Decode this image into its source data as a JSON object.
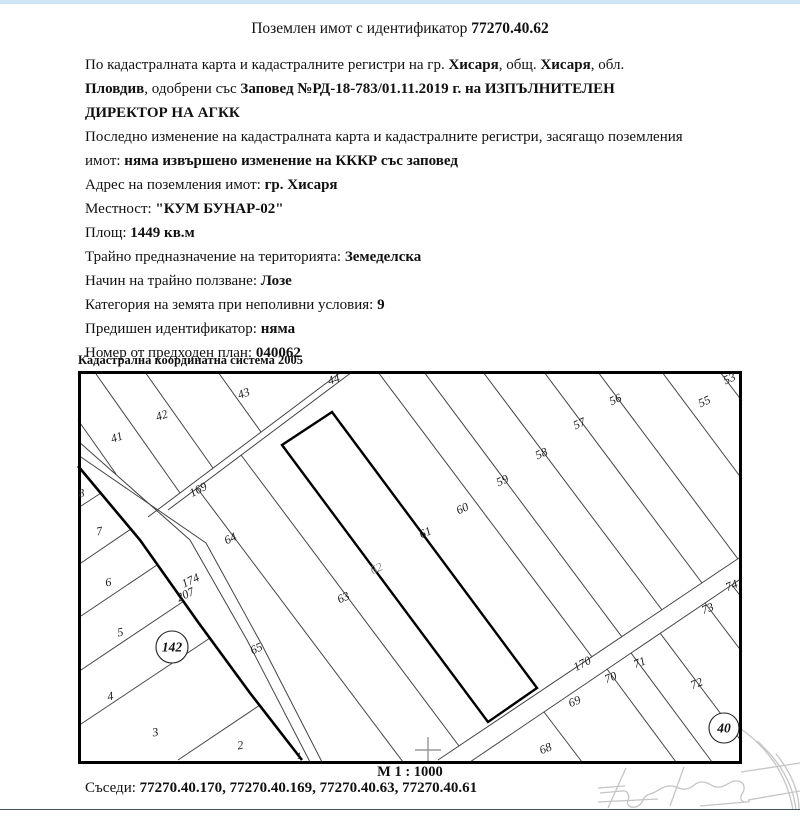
{
  "page": {
    "top_bar_color": "#cfe4f6"
  },
  "title": {
    "prefix": "Поземлен имот с идентификатор ",
    "id": "77270.40.62"
  },
  "text_rows": [
    [
      {
        "t": "По кадастралната карта и кадастралните регистри на гр. "
      },
      {
        "t": "Хисаря",
        "b": 1
      },
      {
        "t": ", общ. "
      },
      {
        "t": "Хисаря",
        "b": 1
      },
      {
        "t": ", обл."
      }
    ],
    [
      {
        "t": "Пловдив",
        "b": 1
      },
      {
        "t": ", одобрени със "
      },
      {
        "t": "Заповед №РД-18-783/01.11.2019 г. на ИЗПЪЛНИТЕЛЕН",
        "b": 1
      }
    ],
    [
      {
        "t": "ДИРЕКТОР НА АГКК",
        "b": 1
      }
    ],
    [
      {
        "t": "Последно изменение на кадастралната карта и кадастралните регистри, засягащо поземления"
      }
    ],
    [
      {
        "t": "имот: "
      },
      {
        "t": "няма извършено изменение на КККР със заповед",
        "b": 1
      }
    ],
    [
      {
        "t": "Адрес на поземления имот: "
      },
      {
        "t": "гр. Хисаря",
        "b": 1
      }
    ],
    [
      {
        "t": "Местност: "
      },
      {
        "t": "\"КУМ БУНАР-02\"",
        "b": 1
      }
    ],
    [
      {
        "t": "Площ: "
      },
      {
        "t": "1449 кв.м",
        "b": 1
      }
    ],
    [
      {
        "t": "Трайно предназначение на територията: "
      },
      {
        "t": "Земеделска",
        "b": 1
      }
    ],
    [
      {
        "t": "Начин на трайно ползване: "
      },
      {
        "t": "Лозе",
        "b": 1
      }
    ],
    [
      {
        "t": "Категория на земята при неполивни условия: "
      },
      {
        "t": "9",
        "b": 1
      }
    ],
    [
      {
        "t": "Предишен идентификатор: "
      },
      {
        "t": "няма",
        "b": 1
      }
    ],
    [
      {
        "t": "Номер от предходен план: "
      },
      {
        "t": "040062",
        "b": 1
      }
    ]
  ],
  "map": {
    "coordinate_system_label": "Кадастрална координатна система 2005",
    "scale_label": "М 1 : 1000",
    "parcel_labels": [
      {
        "text": "41",
        "x": 118,
        "y": 441,
        "rot": -20
      },
      {
        "text": "42",
        "x": 163,
        "y": 419,
        "rot": -20
      },
      {
        "text": "43",
        "x": 245,
        "y": 397,
        "rot": -20
      },
      {
        "text": "44",
        "x": 335,
        "y": 383,
        "rot": -20
      },
      {
        "text": "53",
        "x": 731,
        "y": 382,
        "rot": -25
      },
      {
        "text": "55",
        "x": 706,
        "y": 405,
        "rot": -25
      },
      {
        "text": "56",
        "x": 617,
        "y": 403,
        "rot": -25
      },
      {
        "text": "57",
        "x": 581,
        "y": 427,
        "rot": -25
      },
      {
        "text": "58",
        "x": 543,
        "y": 457,
        "rot": -25
      },
      {
        "text": "59",
        "x": 504,
        "y": 484,
        "rot": -25
      },
      {
        "text": "60",
        "x": 464,
        "y": 512,
        "rot": -25
      },
      {
        "text": "61",
        "x": 427,
        "y": 536,
        "rot": -25
      },
      {
        "text": "62",
        "x": 378,
        "y": 572,
        "rot": -25,
        "gray": true
      },
      {
        "text": "63",
        "x": 345,
        "y": 601,
        "rot": -25
      },
      {
        "text": "64",
        "x": 232,
        "y": 542,
        "rot": -25
      },
      {
        "text": "65",
        "x": 258,
        "y": 652,
        "rot": -25
      },
      {
        "text": "169",
        "x": 200,
        "y": 493,
        "rot": -28
      },
      {
        "text": "174",
        "x": 192,
        "y": 584,
        "rot": -25
      },
      {
        "text": "207",
        "x": 187,
        "y": 598,
        "rot": -25
      },
      {
        "text": "170",
        "x": 584,
        "y": 667,
        "rot": -28
      },
      {
        "text": "68",
        "x": 547,
        "y": 752,
        "rot": -22
      },
      {
        "text": "69",
        "x": 576,
        "y": 705,
        "rot": -22
      },
      {
        "text": "70",
        "x": 612,
        "y": 681,
        "rot": -22
      },
      {
        "text": "71",
        "x": 641,
        "y": 666,
        "rot": -22
      },
      {
        "text": "72",
        "x": 698,
        "y": 687,
        "rot": -22
      },
      {
        "text": "73",
        "x": 709,
        "y": 612,
        "rot": -22
      },
      {
        "text": "74",
        "x": 733,
        "y": 589,
        "rot": -22
      },
      {
        "text": "8",
        "x": 82,
        "y": 497,
        "rot": -10
      },
      {
        "text": "7",
        "x": 100,
        "y": 535,
        "rot": -10
      },
      {
        "text": "6",
        "x": 109,
        "y": 586,
        "rot": -10
      },
      {
        "text": "5",
        "x": 121,
        "y": 636,
        "rot": -10
      },
      {
        "text": "4",
        "x": 111,
        "y": 700,
        "rot": -10
      },
      {
        "text": "3",
        "x": 156,
        "y": 736,
        "rot": -10
      },
      {
        "text": "2",
        "x": 241,
        "y": 749,
        "rot": -10
      },
      {
        "text": "1",
        "x": 299,
        "y": 759,
        "rot": 0,
        "small": true
      }
    ],
    "circled_labels": [
      {
        "text": "142",
        "cx": 172,
        "cy": 647,
        "r": 16
      },
      {
        "text": "40",
        "cx": 724,
        "cy": 728,
        "r": 15
      }
    ]
  },
  "neighbors": {
    "label": "Съседи: ",
    "value": "77270.40.170, 77270.40.169, 77270.40.63, 77270.40.61"
  }
}
